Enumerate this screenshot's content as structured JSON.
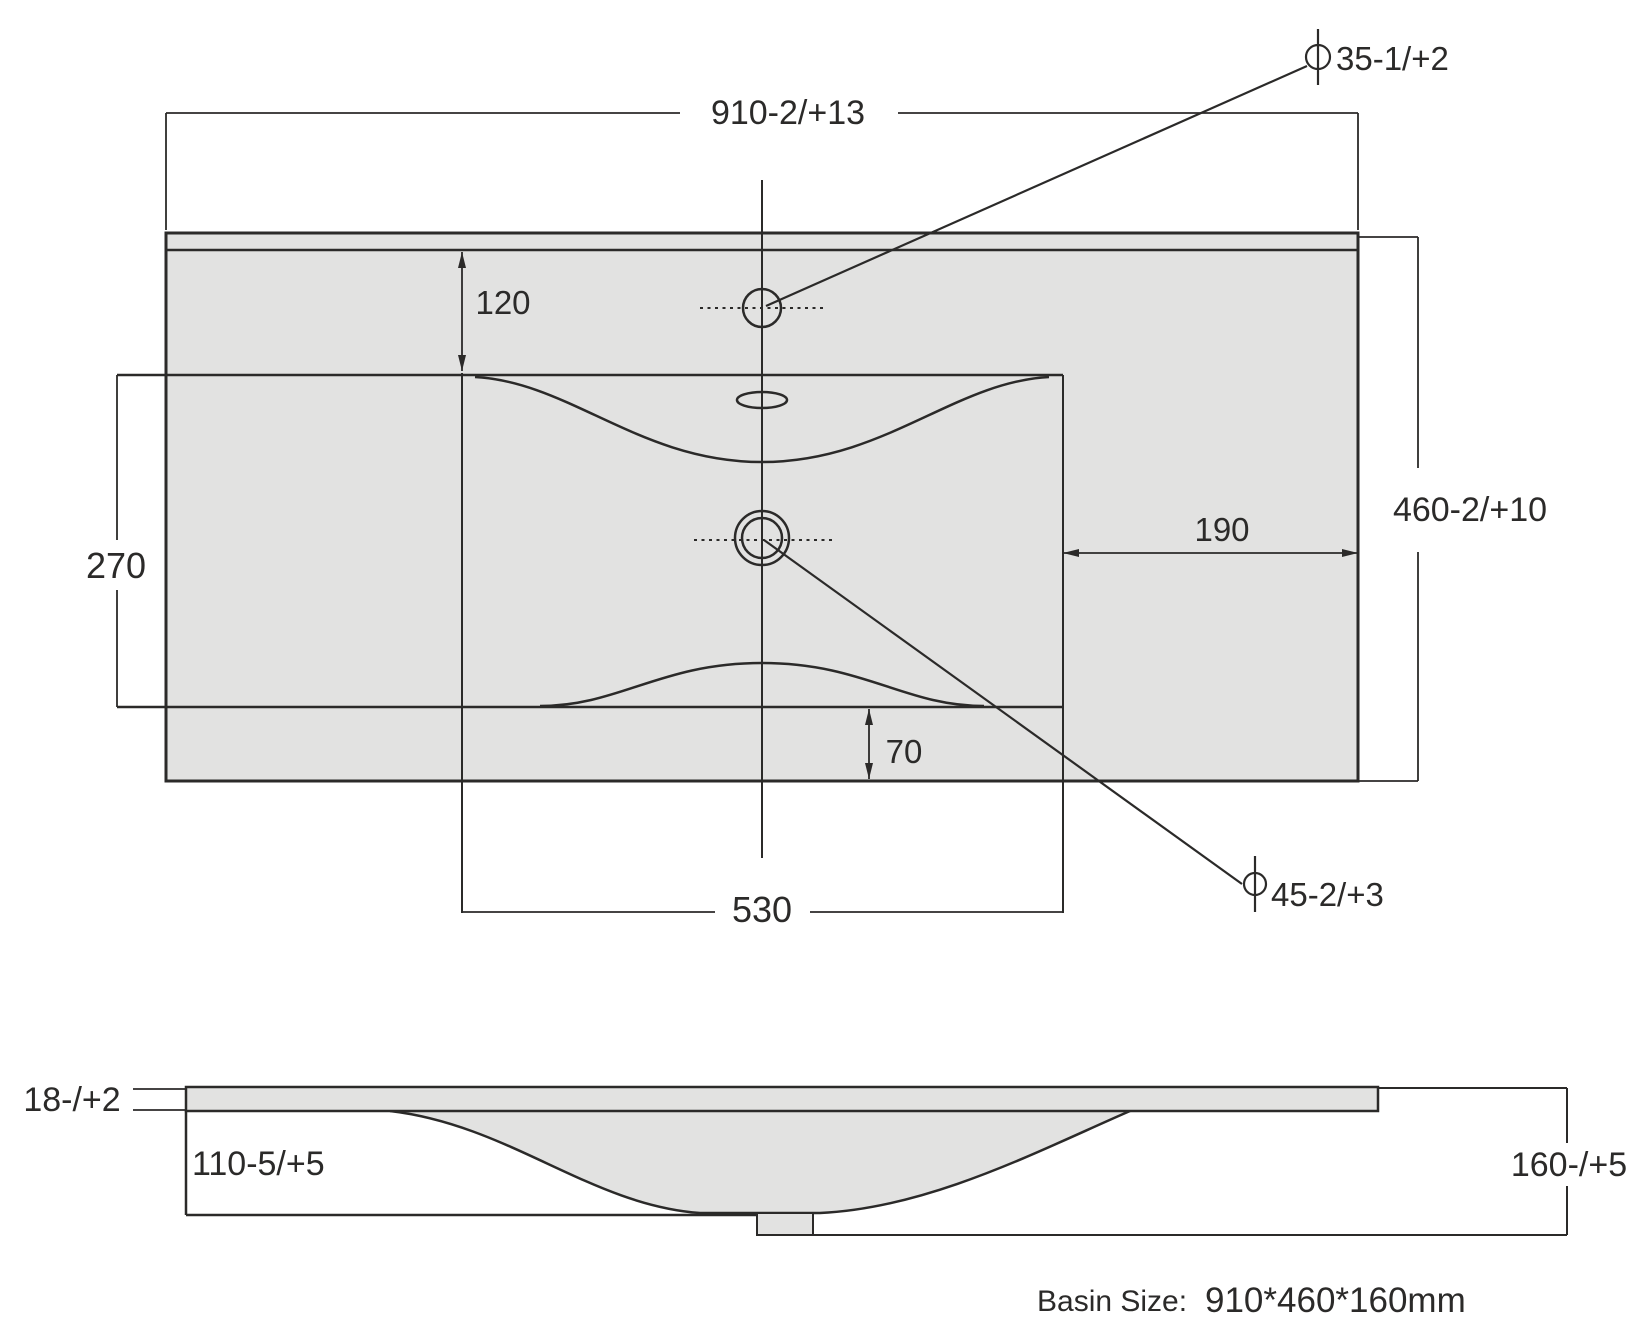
{
  "top_view": {
    "width_dim": "910-2/+13",
    "height_dim": "460-2/+10",
    "faucet_offset_dim": "120",
    "basin_depth_dim": "270",
    "right_inset_dim": "190",
    "bottom_inset_dim": "70",
    "basin_width_dim": "530",
    "faucet_hole_dim": "35-1/+2",
    "drain_hole_dim": "45-2/+3"
  },
  "side_view": {
    "thickness_dim": "18-/+2",
    "apron_height_dim": "110-5/+5",
    "overall_height_dim": "160-/+5"
  },
  "caption": {
    "label": "Basin Size:",
    "value": "910*460*160mm"
  },
  "colors": {
    "line": "#2b2a29",
    "surface_fill": "#e2e2e1",
    "background": "#ffffff"
  }
}
